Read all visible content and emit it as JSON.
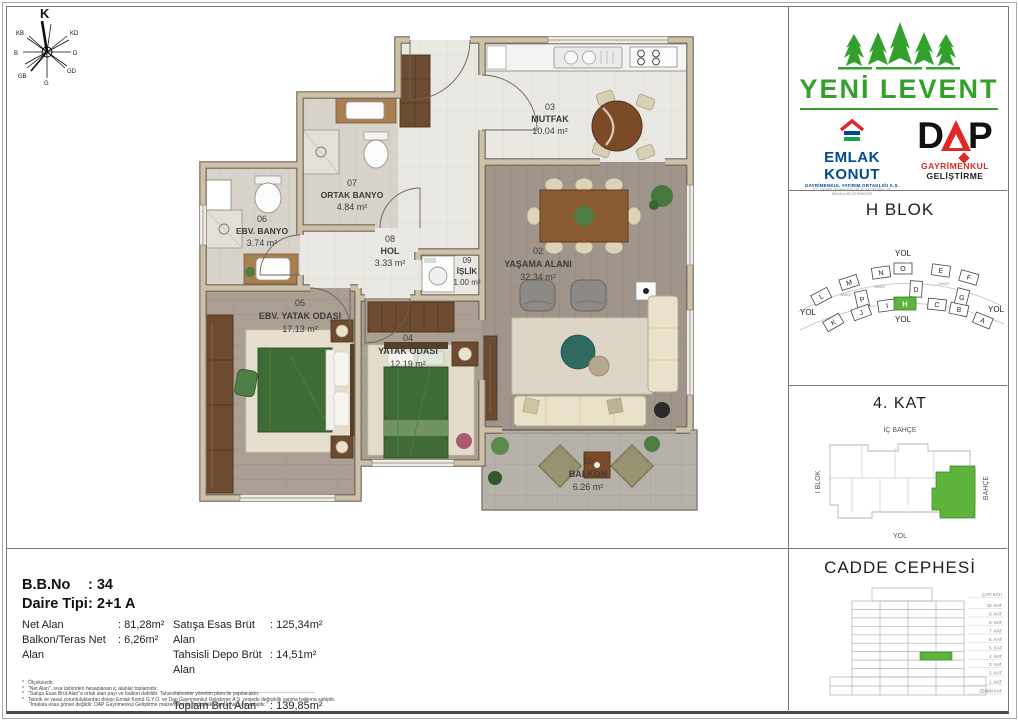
{
  "compass": {
    "n": "K",
    "ne": "KD",
    "e": "D",
    "se": "GD",
    "s": "G",
    "sw": "GB",
    "w": "B",
    "nw": "KB"
  },
  "plan": {
    "rooms": [
      {
        "no": "03",
        "name": "MUTFAK",
        "area": "10.04 m²"
      },
      {
        "no": "07",
        "name": "ORTAK BANYO",
        "area": "4.84 m²"
      },
      {
        "no": "06",
        "name": "EBV. BANYO",
        "area": "3.74 m²"
      },
      {
        "no": "08",
        "name": "HOL",
        "area": "3.33 m²"
      },
      {
        "no": "09",
        "name": "İŞLİK",
        "area": "1.00 m²"
      },
      {
        "no": "02",
        "name": "YAŞAMA ALANI",
        "area": "32.34 m²"
      },
      {
        "no": "05",
        "name": "EBV. YATAK ODASI",
        "area": "17.13 m²"
      },
      {
        "no": "04",
        "name": "YATAK ODASI",
        "area": "12.19 m²"
      },
      {
        "no": "10",
        "name": "BALKON",
        "area": "6.26 m²"
      }
    ]
  },
  "branding": {
    "project_name": "YENİ LEVENT",
    "emlak_konut": {
      "name": "EMLAK KONUT",
      "subtitle": "GAYRİMENKUL YATIRIM ORTAKLIĞI A.Ş.",
      "subtitle2": "T.C. ÇEVRE, ŞEHİRCİLİK VE İKLİM DEĞİŞİKLİĞİ BAKANLIĞI İŞTİRAKİDİR"
    },
    "dap": {
      "d": "D",
      "p": "P",
      "subtitle_red": "GAYRİMENKUL",
      "subtitle_black": "GELİŞTİRME"
    }
  },
  "panels": {
    "block": {
      "title": "H BLOK",
      "road_top": "YOL",
      "road_left": "YOL",
      "road_right": "YOL",
      "road_bottom": "YOL",
      "garden_label": "BAHÇE",
      "blocks_top": [
        "L",
        "M",
        "N",
        "O",
        "E",
        "F"
      ],
      "blocks_mid": [
        "P",
        "D",
        "G"
      ],
      "blocks_bottom": [
        "K",
        "J",
        "I",
        "H",
        "C",
        "B",
        "A"
      ],
      "highlight_color": "#5cb53a"
    },
    "floor": {
      "title": "4. KAT",
      "label_top": "İÇ BAHÇE",
      "label_left": "I BLOK",
      "label_right": "BAHÇE",
      "label_bottom": "YOL"
    },
    "facade": {
      "title": "CADDE CEPHESİ",
      "floors": [
        "ÇATI KATI",
        "10. KAT",
        "9. KAT",
        "8. KAT",
        "7. KAT",
        "6. KAT",
        "5. KAT",
        "4. KAT",
        "3. KAT",
        "2. KAT",
        "1. KAT",
        "ZEMİN KAT"
      ]
    }
  },
  "info": {
    "bb_no_label": "B.B.No",
    "bb_no_value": ": 34",
    "daire_tipi_label": "Daire Tipi",
    "daire_tipi_value": ": 2+1 A",
    "net_alan_label": "Net Alan",
    "net_alan_value": ": 81,28m²",
    "balkon_label": "Balkon/Teras Net Alan",
    "balkon_value": ": 6,26m²",
    "satis_label": "Satışa Esas Brüt Alan",
    "satis_value": ": 125,34m²",
    "depo_label": "Tahsisli Depo Brüt Alan",
    "depo_value": ": 14,51m²",
    "toplam_label": "Toplam Brüt Alan",
    "toplam_value": ": 139,85m²"
  },
  "disclaimer": {
    "line0": "*   Ölçeksizdir.",
    "line1": "*   \"Net Alan\", sıva üstünden hesaplanan iç alanlar toplamıdır.",
    "line2": "*   \"Satışa Esas Brüt Alan\"a ortak alan payı ve balkon dahildir. Tahsis/tahsisler yönetim planı ile yapılacaktır.",
    "line3": "*   Teknik ve yasal zorunluluklardan dolayı Emlak Konut G.Y.O. ve Dap Gayrimenkul Geliştirme A.Ş. projede değişiklik yapma hakkına sahiptir.",
    "line4": "     \"İmalata esas görsel değildir. DAP Gayrimenkul Geliştirme malzemelerde değişiklik yapma hakkına sahiptir.\""
  },
  "colors": {
    "brand_green": "#33a02c",
    "highlight_green": "#5cb53a",
    "emlak_blue": "#004a93",
    "dap_red": "#e02826"
  }
}
